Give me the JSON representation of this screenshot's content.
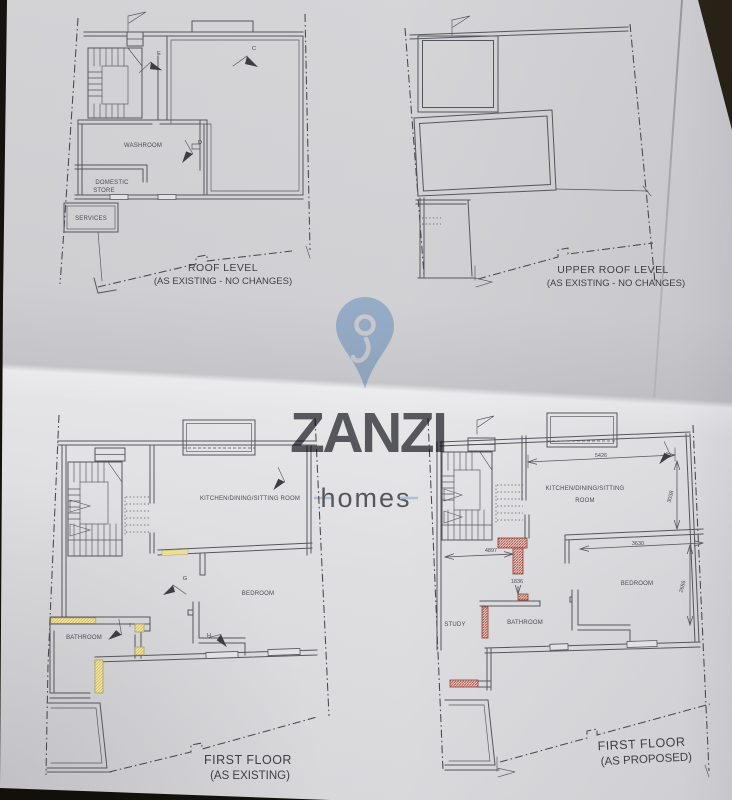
{
  "watermark": {
    "brand": "ZANZI",
    "tagline": "homes"
  },
  "colors": {
    "watermark_blue": "#a6c9eb",
    "demolition_yellow": "#ecdf9b",
    "new_wall_red": "#a8372c",
    "paper": "#e2e2e4",
    "ink": "#55555d"
  },
  "plans": {
    "roof": {
      "title": "ROOF LEVEL",
      "subtitle": "(AS EXISTING - NO CHANGES)",
      "rooms": {
        "washroom": "WASHROOM",
        "domestic_store_line1": "DOMESTIC",
        "domestic_store_line2": "STORE",
        "services": "SERVICES"
      },
      "markers": {
        "c": "C",
        "d": "D",
        "e": "E"
      }
    },
    "upper_roof": {
      "title": "UPPER ROOF LEVEL",
      "subtitle": "(AS EXISTING - NO CHANGES)"
    },
    "first_existing": {
      "title": "FIRST FLOOR",
      "subtitle": "(AS EXISTING)",
      "rooms": {
        "kitchen": "KITCHEN/DINING/SITTING ROOM",
        "bedroom": "BEDROOM",
        "bathroom": "BATHROOM"
      },
      "markers": {
        "g": "G",
        "h": "H",
        "i": "I"
      }
    },
    "first_proposed": {
      "title": "FIRST FLOOR",
      "subtitle": "(AS PROPOSED)",
      "rooms": {
        "kitchen_line1": "KITCHEN/DINING/SITTING",
        "kitchen_line2": "ROOM",
        "bedroom": "BEDROOM",
        "study": "STUDY",
        "bathroom": "BATHROOM"
      },
      "dimensions": {
        "kitchen_width": "5426",
        "kitchen_depth": "3038",
        "bedroom_width": "3630",
        "hall_width": "4897",
        "lobby_depth": "1836",
        "bedroom_depth": "2686"
      }
    }
  }
}
